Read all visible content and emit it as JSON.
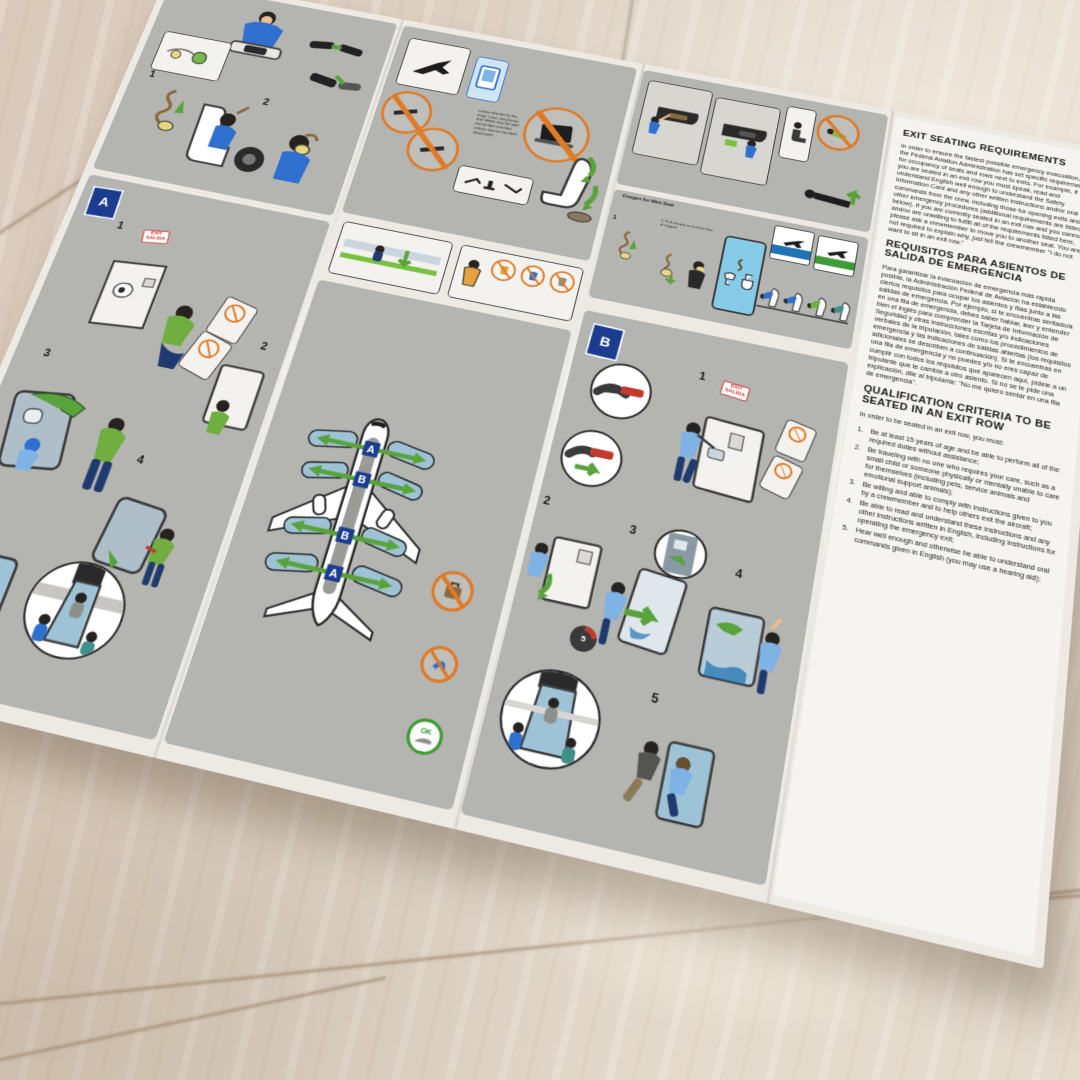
{
  "badges": {
    "a": "A",
    "b": "B",
    "ok": "OK",
    "gauge": "5"
  },
  "exit_sign": {
    "line1": "EXIT",
    "line2": "SALIDA"
  },
  "steps": {
    "a": [
      "1",
      "2",
      "3",
      "4",
      "5"
    ],
    "b": [
      "1",
      "2",
      "3",
      "4",
      "5"
    ],
    "oxygen": [
      "1",
      "2"
    ]
  },
  "aircraft": {
    "exit_labels": [
      "A",
      "B",
      "B",
      "A"
    ]
  },
  "captions": {
    "oxygen_mint_title": "Oxygen for Mint Seat",
    "oxygen_mint_step": "2. Pull sharply to start the flow of oxygen",
    "device_note": "Unless directed by the Flight Crew, cell phones and tablets may be used during flight provided cellular service has been deactivated"
  },
  "text_panel": {
    "english": {
      "title": "EXIT SEATING REQUIREMENTS",
      "body": "In order to ensure the fastest possible emergency evacuation, the Federal Aviation Administration has set specific requirements for occupancy of seats and rows next to exits. For example, if you are seated in an exit row you must speak, read and understand English well enough to understand the Safety Information Card and any other written instructions and/or oral commands from the crew, including those for opening exits and other emergency procedures (additional requirements are listed below). If you are currently seated in an exit row and you cannot and/or are unwilling to fulfill all of the requirements listed here, please ask a crewmember to move you to another seat. You are not required to explain why, just tell the crewmember \"I do not want to sit in an exit row.\""
    },
    "spanish": {
      "title": "REQUISITOS PARA ASIENTOS DE SALIDA DE EMERGENCIA",
      "body": "Para garantizar la evacuación de emergencia más rápida posible, la Administración Federal de Aviación ha establecido ciertos requisitos para ocupar los asientos y filas junto a las salidas de emergencia. Por ejemplo, si te encuentras sentado/a en una fila de emergencia, debes saber hablar, leer y entender bien el inglés para comprender la Tarjeta de Información de Seguridad y otras instrucciones escritas y/o indicaciones verbales de la tripulación, tales como los procedimientos de emergencia y las indicaciones de salidas abiertas (los requisitos adicionales se describen a continuación). Si te encuentras en una fila de emergencia y no puedes y/o no eres capaz de cumplir con todos los requisitos que aparecen aquí, pídele a un tripulante que te cambie a otro asiento. Si no se te pide una explicación, dile al tripulante: \"No me quiero sentar en una fila de emergencia\"."
    },
    "qualification": {
      "title": "QUALIFICATION CRITERIA TO BE SEATED IN AN EXIT ROW",
      "intro": "In order to be seated in an exit row, you must:",
      "items": [
        {
          "num": "1.",
          "text": "Be at least 15 years of age and be able to perform all of the required duties without assistance;"
        },
        {
          "num": "2.",
          "text": "Be traveling with no one who requires your care, such as a small child or someone physically or mentally unable to care for themselves (including pets, service animals and emotional support animals);"
        },
        {
          "num": "3.",
          "text": "Be willing and able to comply with instructions given to you by a crewmember and to help others exit the aircraft;"
        },
        {
          "num": "4.",
          "text": "Be able to read and understand these instructions and any other instructions written in English, including instructions for operating the emergency exit;"
        },
        {
          "num": "5.",
          "text": "Hear well enough and otherwise be able to understand oral commands given in English (you may use a hearing aid);"
        }
      ]
    }
  },
  "colors": {
    "panel_gray": "#b4b4b0",
    "accent_navy": "#1c3d8f",
    "arrow_green": "#58a33c",
    "prohibit_orange": "#e07a25",
    "exit_red": "#d0342c",
    "slide_blue": "#9fc3d6",
    "water_blue": "#2273b5",
    "land_green": "#3f9b35",
    "lavatory_blue": "#86cbe8"
  }
}
